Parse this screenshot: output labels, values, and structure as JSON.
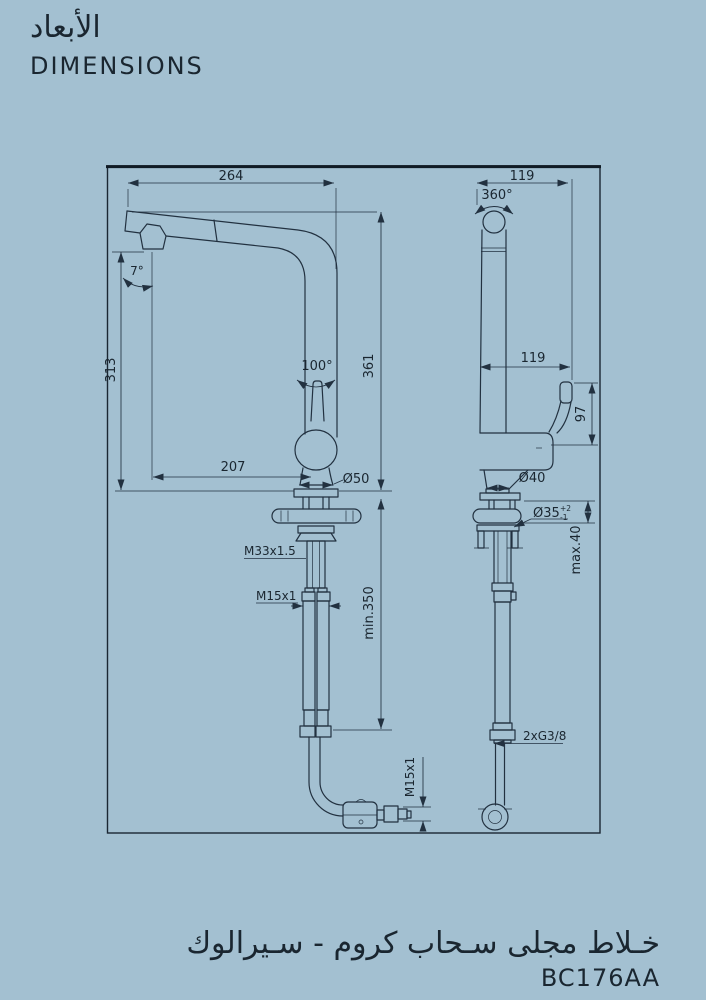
{
  "header": {
    "title_ar": "الأبعاد",
    "title_en": "DIMENSIONS"
  },
  "footer": {
    "product_ar": "خـلاط مجلى سـحاب كروم - سـيرالوك",
    "product_code": "BC176AA"
  },
  "colors": {
    "background": "#a3c0d1",
    "line": "#223140",
    "text": "#1a2630"
  },
  "diagram": {
    "labels": {
      "spout_reach": "264",
      "depth_top": "119",
      "swivel_angle": "360°",
      "spout_height": "313",
      "handle_angle": "100°",
      "total_height": "361",
      "depth_mid": "119",
      "handle_height": "97",
      "projection": "207",
      "base_dia_front": "Ø50",
      "base_dia_side": "Ø40",
      "hole_dia": "Ø35",
      "hole_tol_plus": "+2",
      "hole_tol_minus": "-1",
      "deck_thickness": "max.40",
      "shank_thread": "M33x1.5",
      "hose_thread": "M15x1",
      "hose_length": "min.350",
      "supply_thread": "2xG3/8",
      "spray_hose_thread": "M15x1",
      "spout_tilt": "7°"
    }
  }
}
